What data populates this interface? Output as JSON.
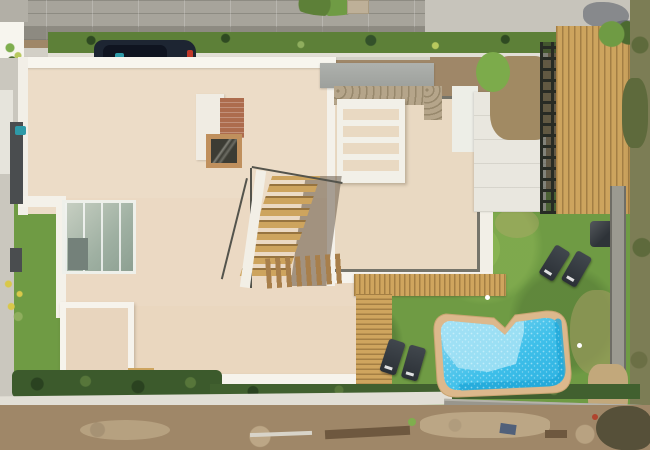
{
  "scene": {
    "type": "aerial-drone-photo",
    "description": "Top-down aerial view of a modern villa under bright sunlight: flat cream roof with white parapets, entrance canopy with stone wall and white pergola, brick chimney with skylight, L-shaped exterior wooden staircase, glass atrium, wooden decks, dark privacy fence, green lawn with sun loungers, irregular blue swimming pool with tan coping, cobblestone street with a parked dark car at top, hedge rows, boundary walls and a dirt construction road at the bottom",
    "objects": [
      "cobblestone-street",
      "sidewalk",
      "hedge-row",
      "parked-car",
      "villa-roof",
      "roof-parapet",
      "entrance-canopy",
      "stone-wall",
      "white-pergola",
      "brick-chimney",
      "skylight",
      "exterior-staircase",
      "glass-atrium",
      "terrace",
      "entrance-platform",
      "privacy-fence",
      "wooden-deck",
      "lawn",
      "sun-loungers",
      "side-table",
      "swimming-pool",
      "pool-coping",
      "boundary-wall",
      "vegetation-strip",
      "dirt-road",
      "construction-debris"
    ]
  },
  "colors": {
    "street": "#a7a49b",
    "pavement": "#c7c4bb",
    "sidewalk": "#d2cfc6",
    "hedge": "#5d8038",
    "hedgedark": "#3c5a2c",
    "lawn": "#6f9b44",
    "lawndry": "#9d9b5d",
    "roof": "#ecdcc7",
    "parapet": "#f7f5ee",
    "canopy": "#9da09c",
    "stone": "#b5a58a",
    "wood": "#cda45e",
    "glass": "#74817a",
    "shadowwin": "#4a4d4f",
    "fence": "#272b24",
    "car": "#1d2532",
    "carglass": "#0f1420",
    "taillight": "#c0392b",
    "teal": "#2e9aa8",
    "brick": "#ad6c4d",
    "flower": "#d9c84a",
    "platform": "#e9e7df",
    "lounger": "#2b3036",
    "wall": "#9b9a91",
    "dirt": "#a18a63",
    "dirtroad": "#9f8768",
    "sand": "#c2a87b",
    "debris": "#6e583f",
    "vegetation": "#7c7d55",
    "poolCoping": "#dcb88c",
    "poolShallow": "#a7e3f6",
    "poolWater": "#3fc0ea",
    "poolDeep": "#21a7d8"
  }
}
